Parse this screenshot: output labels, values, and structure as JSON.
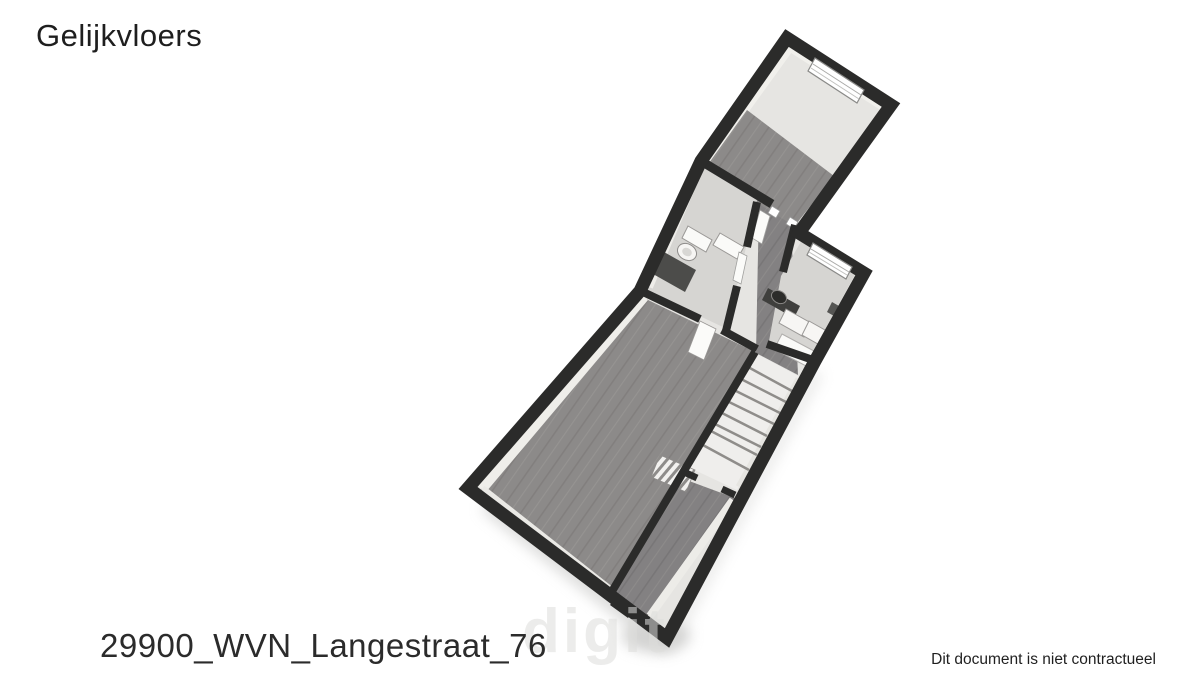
{
  "page": {
    "background_color": "#ffffff"
  },
  "header": {
    "title": "Gelijkvloers"
  },
  "plan": {
    "floor_shown": "Gelijkvloers",
    "colors": {
      "wall": "#2b2b2a",
      "wood_floor": "#8c8a89",
      "tile_floor": "#d6d5d2",
      "interior_base": "#e6e5e2",
      "stairs_fill": "#efeeec",
      "fixture_white": "#fafaf8",
      "shadow": "#a8a8a6"
    }
  },
  "footer": {
    "filename": "29900_WVN_Langestraat_76",
    "watermark": "digit",
    "disclaimer": "Dit document is niet contractueel"
  }
}
